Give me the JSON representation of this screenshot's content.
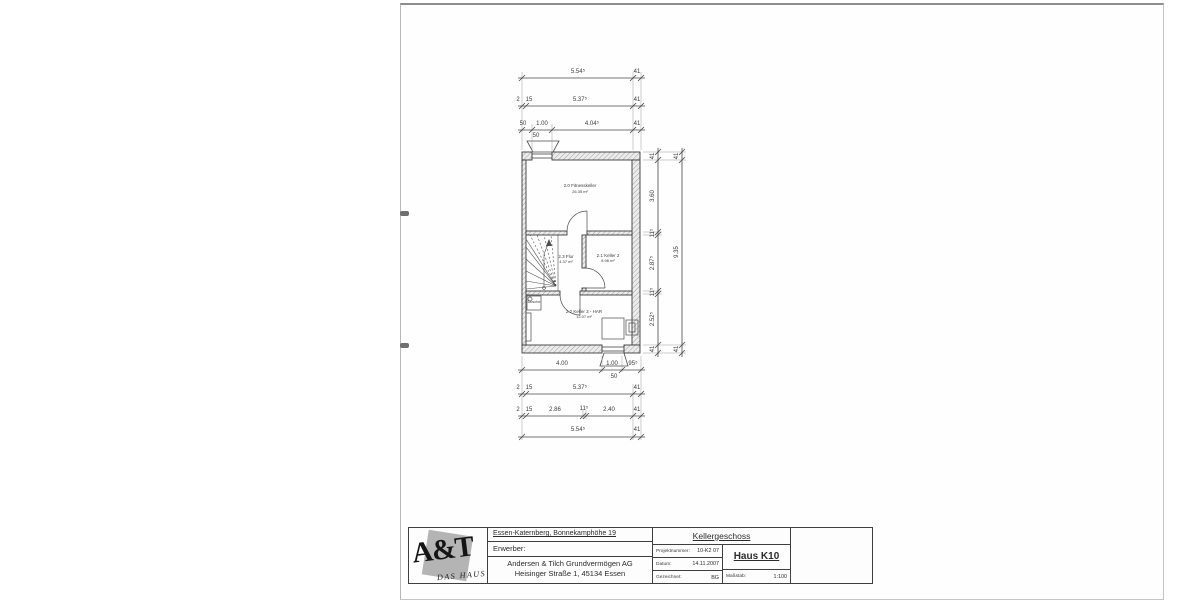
{
  "title_block": {
    "logo_text": "A&T",
    "logo_subtext": "DAS HAUS",
    "site": "Essen-Katernberg, Bonnekamphöhe 19",
    "erwerber_label": "Erwerber:",
    "company_line1": "Andersen & Tilch Grundvermögen AG",
    "company_line2": "Heisinger Straße 1, 45134 Essen",
    "drawing_title": "Kellergeschoss",
    "fields": [
      {
        "label": "Projektnummer:",
        "value": "10-K2 07"
      },
      {
        "label": "Datum:",
        "value": "14.11.2007"
      },
      {
        "label": "Gezeichnet:",
        "value": "BG"
      }
    ],
    "haus": "Haus K10",
    "massstab_label": "Maßstab:",
    "massstab_value": "1:100"
  },
  "plan": {
    "scale": "1:100",
    "rooms": [
      {
        "number": "2.0",
        "name": "Fitnesskeller",
        "area_m2": "26.35"
      },
      {
        "number": "2.1",
        "name": "Keller 2",
        "area_m2": "8.96"
      },
      {
        "number": "2.3",
        "name": "Flur",
        "area_m2": "4.37"
      },
      {
        "number": "2.2",
        "name": "Keller 3 - HAR",
        "area_m2": "12.07"
      }
    ],
    "labels": [
      {
        "n": "dim-label",
        "c": "dim",
        "x": 578,
        "y": 72,
        "t": "5.54⁵"
      },
      {
        "n": "dim-label",
        "c": "dim",
        "x": 637,
        "y": 72,
        "t": "41"
      },
      {
        "n": "dim-label",
        "c": "dim",
        "x": 518,
        "y": 100,
        "t": "2"
      },
      {
        "n": "dim-label",
        "c": "dim",
        "x": 529,
        "y": 100,
        "t": "15"
      },
      {
        "n": "dim-label",
        "c": "dim",
        "x": 580,
        "y": 100,
        "t": "5.37⁵"
      },
      {
        "n": "dim-label",
        "c": "dim",
        "x": 637,
        "y": 100,
        "t": "41"
      },
      {
        "n": "dim-label",
        "c": "dim",
        "x": 523,
        "y": 124,
        "t": "50"
      },
      {
        "n": "dim-label",
        "c": "dim",
        "x": 542,
        "y": 124,
        "t": "1.00"
      },
      {
        "n": "dim-label",
        "c": "dim",
        "x": 592,
        "y": 124,
        "t": "4.04⁵"
      },
      {
        "n": "dim-label",
        "c": "dim",
        "x": 637,
        "y": 124,
        "t": "41"
      },
      {
        "n": "dim-label",
        "c": "dim",
        "x": 536,
        "y": 136,
        "t": "50"
      },
      {
        "n": "dim-label",
        "c": "dim",
        "x": 562,
        "y": 364,
        "t": "4.00"
      },
      {
        "n": "dim-label",
        "c": "dim",
        "x": 612,
        "y": 364,
        "t": "1.00"
      },
      {
        "n": "dim-label",
        "c": "dim",
        "x": 633,
        "y": 364,
        "t": "95⁵"
      },
      {
        "n": "dim-label",
        "c": "dim",
        "x": 614,
        "y": 377,
        "t": "50"
      },
      {
        "n": "dim-label",
        "c": "dim",
        "x": 518,
        "y": 388,
        "t": "2"
      },
      {
        "n": "dim-label",
        "c": "dim",
        "x": 529,
        "y": 388,
        "t": "15"
      },
      {
        "n": "dim-label",
        "c": "dim",
        "x": 580,
        "y": 388,
        "t": "5.37⁵"
      },
      {
        "n": "dim-label",
        "c": "dim",
        "x": 637,
        "y": 388,
        "t": "41"
      },
      {
        "n": "dim-label",
        "c": "dim",
        "x": 518,
        "y": 410,
        "t": "2"
      },
      {
        "n": "dim-label",
        "c": "dim",
        "x": 529,
        "y": 410,
        "t": "15"
      },
      {
        "n": "dim-label",
        "c": "dim",
        "x": 555,
        "y": 410,
        "t": "2.86"
      },
      {
        "n": "dim-label",
        "c": "dim",
        "x": 584,
        "y": 409,
        "t": "11⁵"
      },
      {
        "n": "dim-label",
        "c": "dim",
        "x": 609,
        "y": 410,
        "t": "2.40"
      },
      {
        "n": "dim-label",
        "c": "dim",
        "x": 637,
        "y": 410,
        "t": "41"
      },
      {
        "n": "dim-label",
        "c": "dim",
        "x": 578,
        "y": 430,
        "t": "5.54⁵"
      },
      {
        "n": "dim-label",
        "c": "dim",
        "x": 637,
        "y": 430,
        "t": "41"
      },
      {
        "n": "dim-label",
        "c": "dim",
        "x": 653,
        "y": 156,
        "t": "41",
        "r": -90
      },
      {
        "n": "dim-label",
        "c": "dim",
        "x": 653,
        "y": 196,
        "t": "3.60",
        "r": -90
      },
      {
        "n": "dim-label",
        "c": "dim",
        "x": 653,
        "y": 233,
        "t": "11⁵",
        "r": -90
      },
      {
        "n": "dim-label",
        "c": "dim",
        "x": 653,
        "y": 263,
        "t": "2.87⁵",
        "r": -90
      },
      {
        "n": "dim-label",
        "c": "dim",
        "x": 653,
        "y": 292,
        "t": "11⁵",
        "r": -90
      },
      {
        "n": "dim-label",
        "c": "dim",
        "x": 653,
        "y": 319,
        "t": "2.52⁵",
        "r": -90
      },
      {
        "n": "dim-label",
        "c": "dim",
        "x": 653,
        "y": 349,
        "t": "41",
        "r": -90
      },
      {
        "n": "dim-label",
        "c": "dim",
        "x": 677,
        "y": 156,
        "t": "41",
        "r": -90
      },
      {
        "n": "dim-label",
        "c": "dim",
        "x": 677,
        "y": 252,
        "t": "9.35",
        "r": -90
      },
      {
        "n": "dim-label",
        "c": "dim",
        "x": 677,
        "y": 349,
        "t": "41",
        "r": -90
      },
      {
        "n": "room-label-fitnesskeller",
        "c": "room",
        "x": 580,
        "y": 186,
        "t": "2.0 Fitnesskeller"
      },
      {
        "n": "room-area-fitnesskeller",
        "c": "area",
        "x": 580,
        "y": 192,
        "t": "26.35 m²"
      },
      {
        "n": "room-label-flur",
        "c": "room",
        "x": 566,
        "y": 257,
        "t": "2.3 Flur"
      },
      {
        "n": "room-area-flur",
        "c": "area",
        "x": 566,
        "y": 262,
        "t": "4.37 m²"
      },
      {
        "n": "room-label-keller2",
        "c": "room",
        "x": 608,
        "y": 256,
        "t": "2.1 Keller 2"
      },
      {
        "n": "room-area-keller2",
        "c": "area",
        "x": 608,
        "y": 261,
        "t": "8.96 m²"
      },
      {
        "n": "room-label-keller3",
        "c": "room",
        "x": 584,
        "y": 312,
        "t": "2.2 Keller 3 - HAR"
      },
      {
        "n": "room-area-keller3",
        "c": "area",
        "x": 584,
        "y": 317,
        "t": "12.07 m²"
      },
      {
        "n": "fixture-label-dusche",
        "c": "fixture",
        "x": 534,
        "y": 303,
        "t": "Dusche"
      }
    ]
  }
}
